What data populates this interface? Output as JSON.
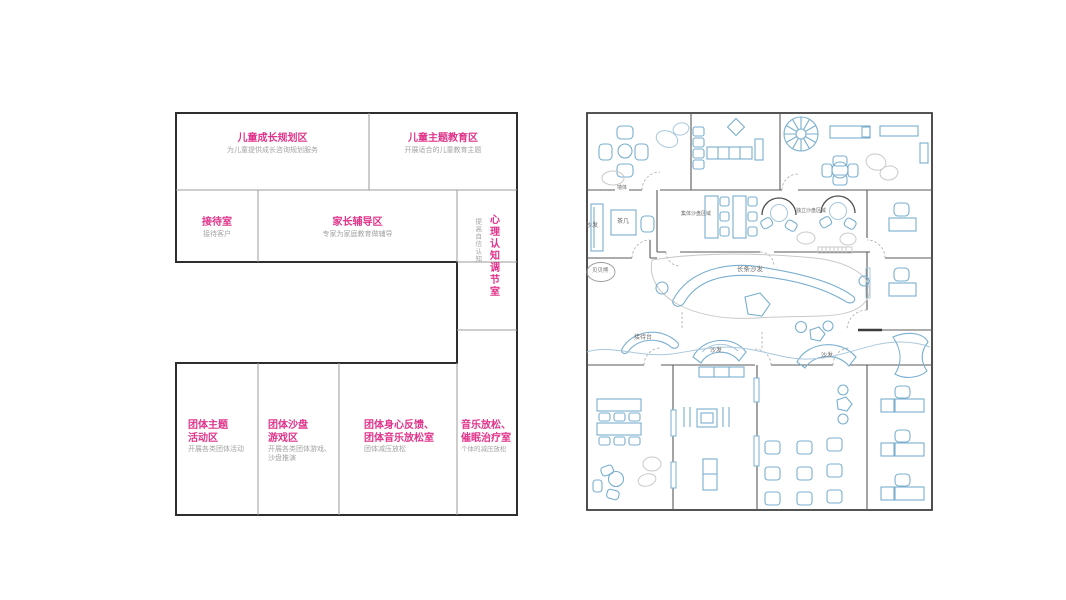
{
  "left_panel": {
    "zones": [
      {
        "id": "child-growth",
        "title": "儿童成长规划区",
        "subtitle": "为儿童提供成长咨询规划服务"
      },
      {
        "id": "child-education",
        "title": "儿童主题教育区",
        "subtitle": "开展适合的儿童教育主题"
      },
      {
        "id": "reception-room",
        "title": "接待室",
        "subtitle": "接待客户"
      },
      {
        "id": "parent-tutoring",
        "title": "家长辅导区",
        "subtitle": "专家为家庭教育做辅导"
      },
      {
        "id": "cognition-room",
        "title": "心理认知调节室",
        "subtitle": "提高自信认知"
      },
      {
        "id": "group-activity",
        "title": "团体主题活动区",
        "subtitle": "开展各类团体活动"
      },
      {
        "id": "group-sandplay",
        "title": "团体沙盘游戏区",
        "subtitle": "开展各类团体游戏、沙盘推演"
      },
      {
        "id": "group-music",
        "title": "团体身心反馈、团体音乐放松室",
        "subtitle": "团体减压放松"
      },
      {
        "id": "hypnosis-room",
        "title": "音乐放松、催眠治疗室",
        "subtitle": "个体的减压放松"
      }
    ]
  },
  "right_panel": {
    "labels": {
      "wall": "墙体",
      "sofa_reception": "沙发",
      "tea_table": "茶几",
      "beibei_bear": "贝贝熊",
      "group_sand": "集体沙盘区域",
      "individual_sand": "独立沙盘区域",
      "long_sofa": "长条沙发",
      "reception_desk": "接待台",
      "sofa_mid": "沙发",
      "sofa_right": "沙发"
    }
  },
  "colors": {
    "accent_pink": "#e0338b",
    "subtitle_gray": "#a3a3a3",
    "furniture_blue": "#7aafcf",
    "wall_dark": "#2e2e2e"
  }
}
